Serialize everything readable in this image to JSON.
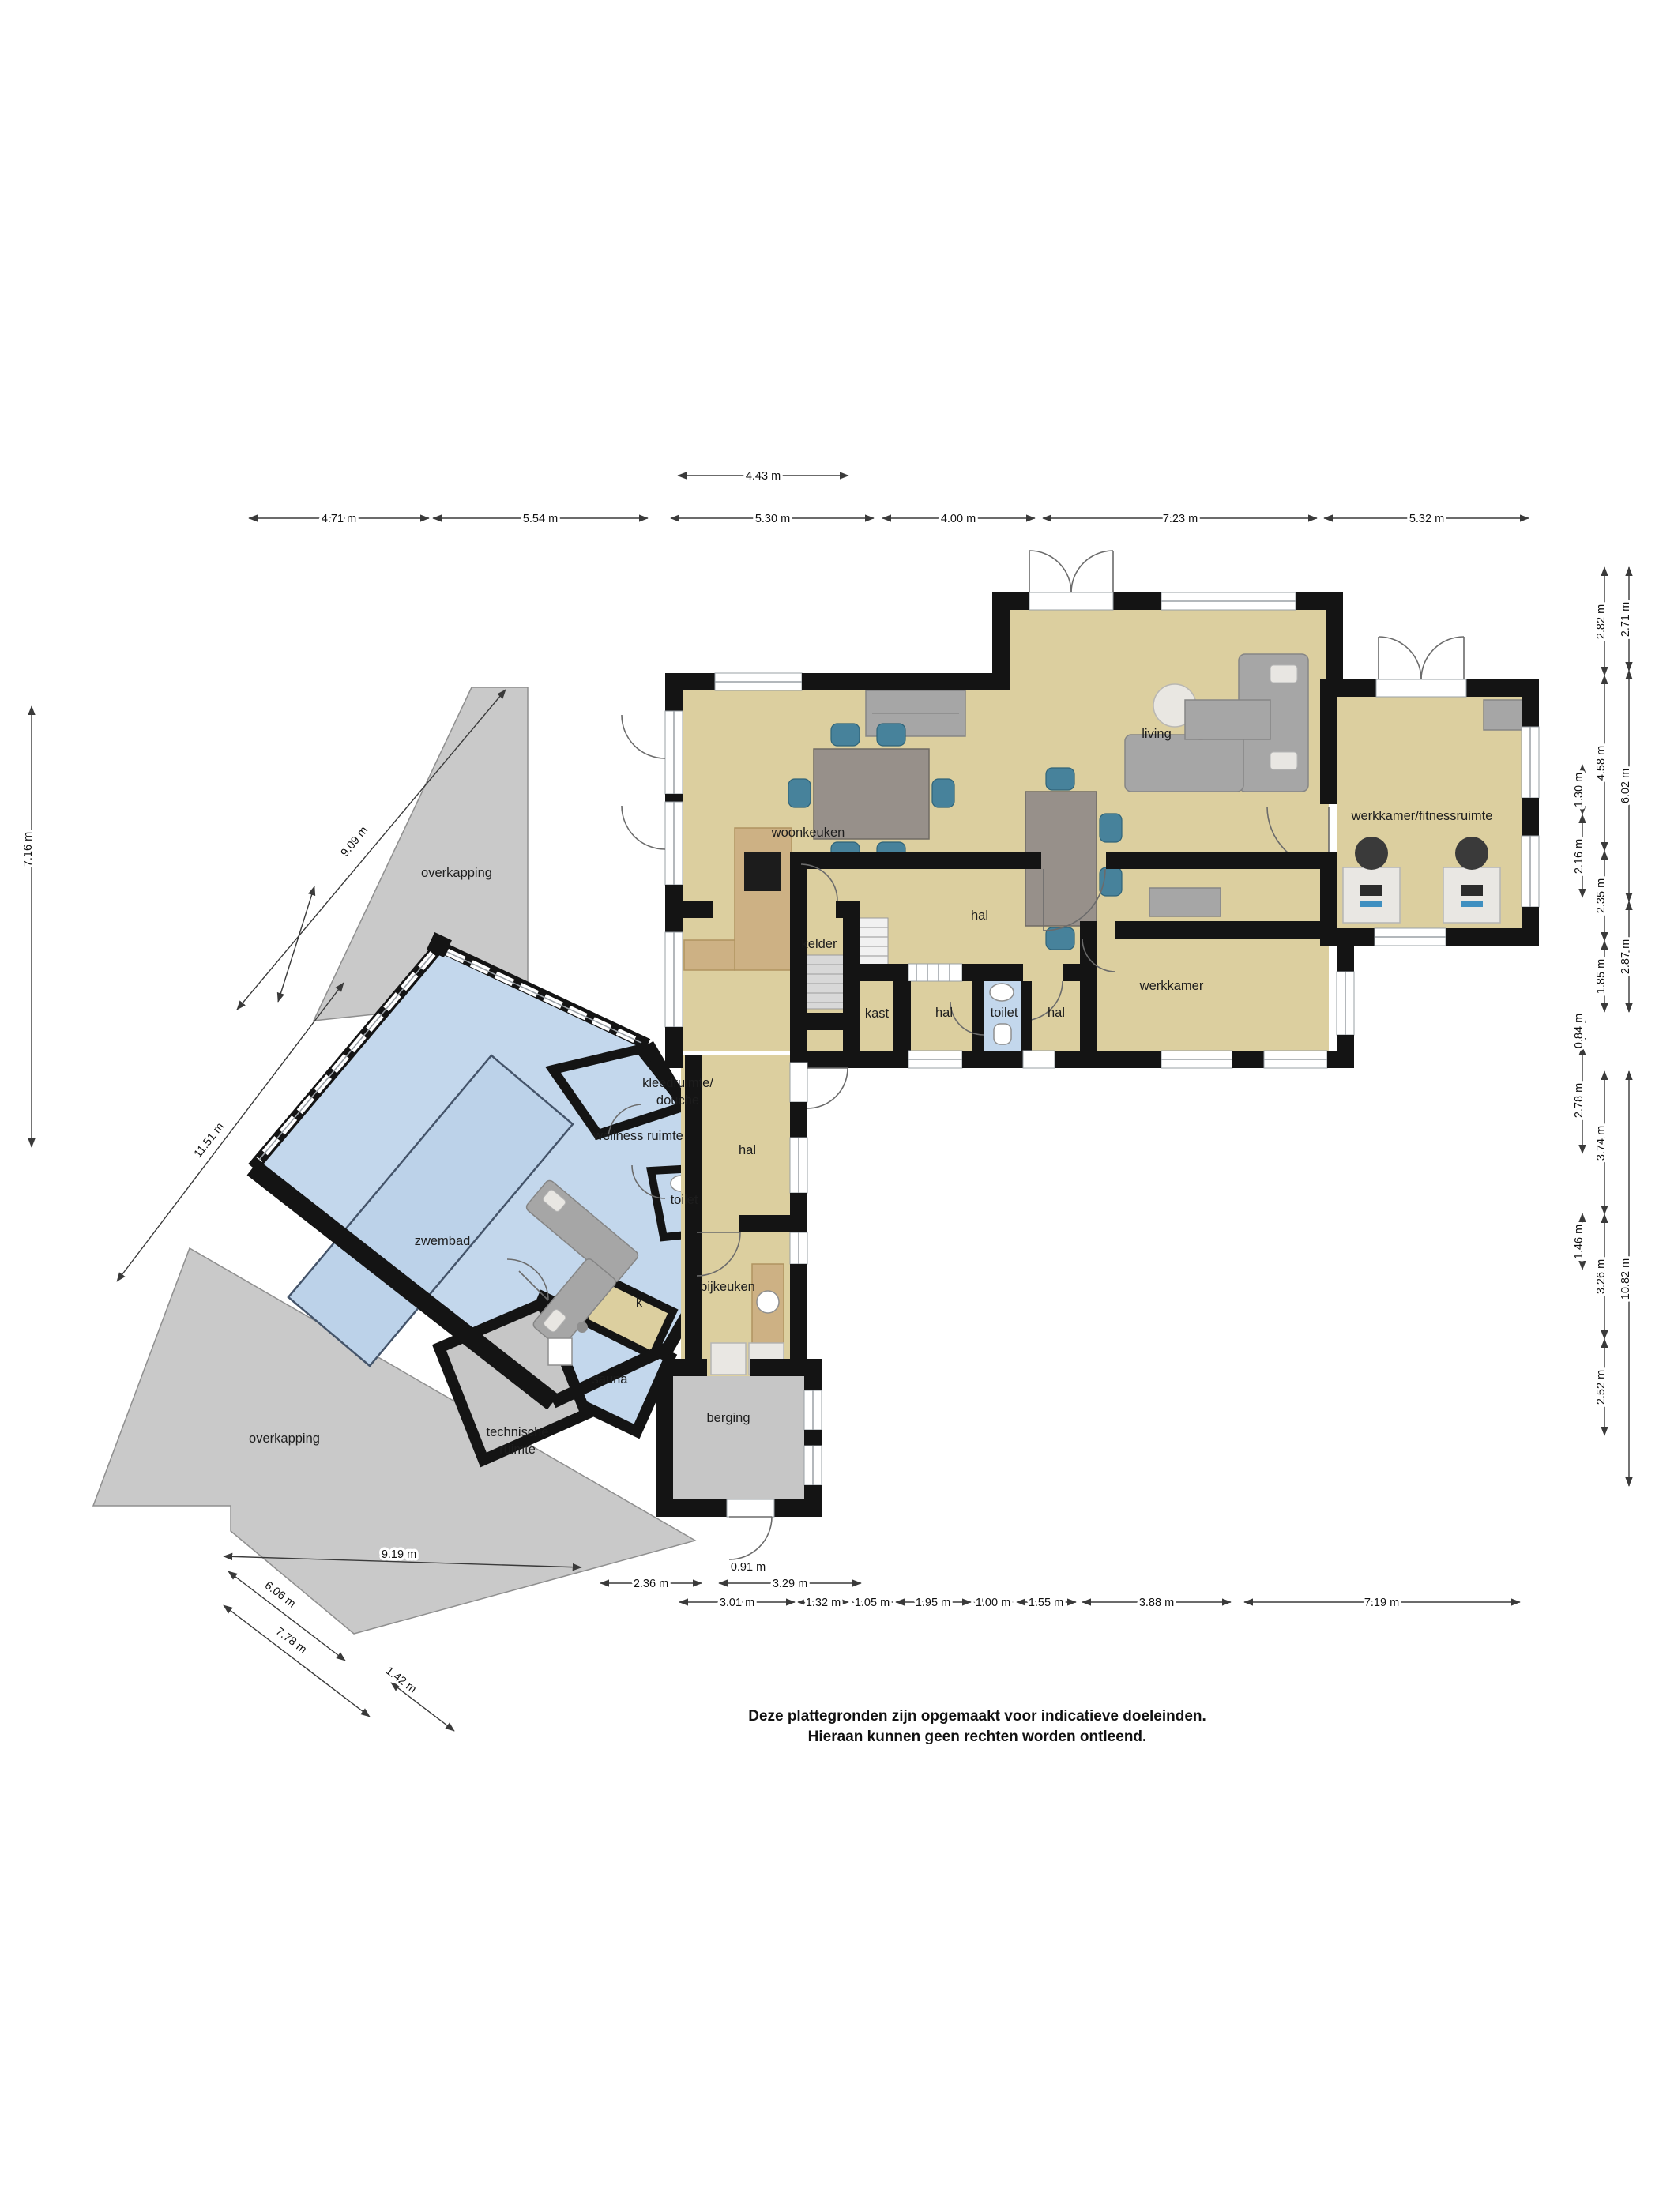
{
  "footer": {
    "line1": "Deze plattegronden zijn opgemaakt voor indicatieve doeleinden.",
    "line2": "Hieraan kunnen geen rechten worden ontleend."
  },
  "rooms": {
    "living": "living",
    "woonkeuken": "woonkeuken",
    "werkkamer_fitness": "werkkamer/fitnessruimte",
    "hal_main": "hal",
    "kelder": "kelder",
    "kast": "kast",
    "hal_small1": "hal",
    "toilet_main": "toilet",
    "hal_small2": "hal",
    "werkkamer": "werkkamer",
    "overkapping_boven": "overkapping",
    "overkapping_onder": "overkapping",
    "zwembad": "zwembad",
    "wellness": "wellness ruimte",
    "kleedruimte_line1": "kleedruimte/",
    "kleedruimte_line2": "douche",
    "toilet_pool": "toilet",
    "k": "k",
    "hal_lower": "hal",
    "bijkeuken": "bijkeuken",
    "sauna": "sauna",
    "technische_line1": "technische",
    "technische_line2": "ruimte",
    "berging": "berging"
  },
  "dims": {
    "top_aux": "4.43 m",
    "top": [
      "4.71 m",
      "5.54 m",
      "5.30 m",
      "4.00 m",
      "7.23 m",
      "5.32 m"
    ],
    "right_inner": [
      "1.30 m",
      "2.16 m",
      "0.84 m",
      "2.78 m",
      "1.46 m"
    ],
    "right_mid": [
      "2.82 m",
      "4.58 m",
      "2.35 m",
      "1.85 m",
      "3.74 m",
      "3.26 m",
      "2.52 m"
    ],
    "right_outer": [
      "2.71 m",
      "6.02 m",
      "2.87 m",
      "10.82 m"
    ],
    "left": "7.16 m",
    "diag_upper": [
      "9.09 m",
      "11.51 m"
    ],
    "diag_lower": [
      "6.06 m",
      "7.78 m",
      "1.42 m"
    ],
    "bottom_row1": [
      "9.19 m",
      "0.91 m"
    ],
    "bottom_row2": [
      "2.36 m",
      "3.29 m"
    ],
    "bottom_row3": [
      "3.01 m",
      "1.32 m",
      "1.05 m",
      "1.95 m",
      "1.00 m",
      "1.55 m",
      "3.88 m",
      "7.19 m"
    ]
  },
  "colors": {
    "floor_tan": "#dccf9f",
    "pool_blue": "#c3d7ec",
    "water_blue": "#bcd2e9",
    "overkapping_grey": "#c9c9c9",
    "wall_black": "#141414",
    "chair_teal": "#47829b"
  }
}
